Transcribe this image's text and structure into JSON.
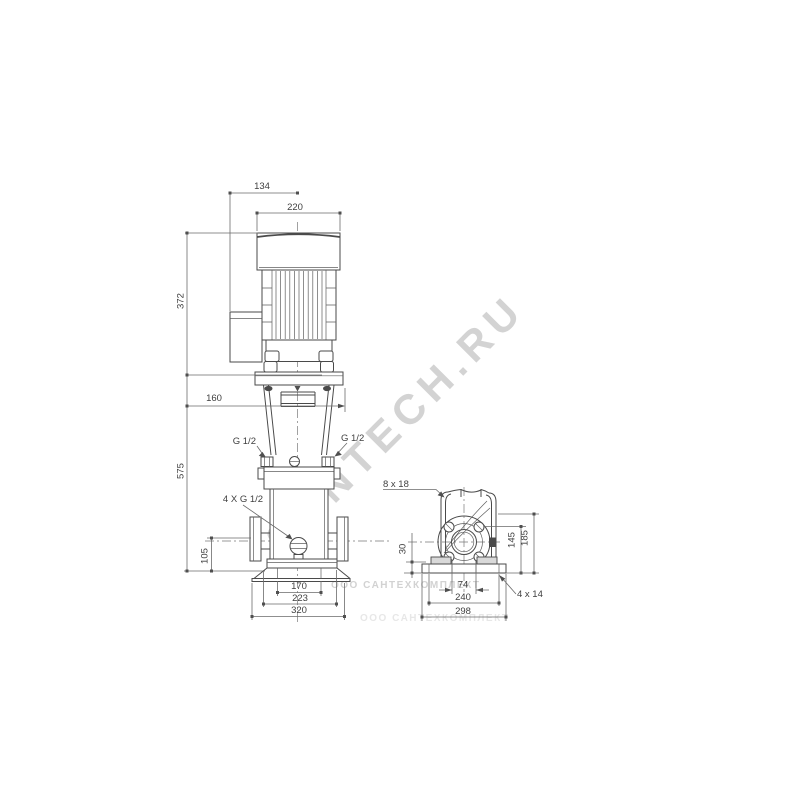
{
  "watermark": {
    "diagonal": "SANTECH.RU",
    "row1": "ООО САНТЕХКОМПЛЕКТ",
    "row2": "ООО САНТЕХКОМПЛЕКТ"
  },
  "front_view": {
    "dims": {
      "terminal_box_offset": "134",
      "motor_cap_width": "220",
      "motor_height": "372",
      "pump_height": "575",
      "stool_width": "160",
      "port_height": "105",
      "base_bolt_span": "170",
      "base_mid_width": "223",
      "base_width": "320"
    },
    "labels": {
      "plug_left": "G 1/2",
      "plug_right": "G 1/2",
      "drain_plugs": "4 X G 1/2"
    }
  },
  "end_view": {
    "dims": {
      "base_plate_height": "30",
      "port_center_height": "145",
      "flange_top_height": "185",
      "feet_slot_span": "74",
      "base_bolt_span": "240",
      "base_plate_width": "298"
    },
    "labels": {
      "flange_holes": "8 x 18",
      "base_holes": "4 x 14"
    }
  },
  "colors": {
    "line": "#4a4a4a",
    "dimension": "#6b6b6b",
    "watermark": "#999999",
    "background": "#ffffff"
  }
}
